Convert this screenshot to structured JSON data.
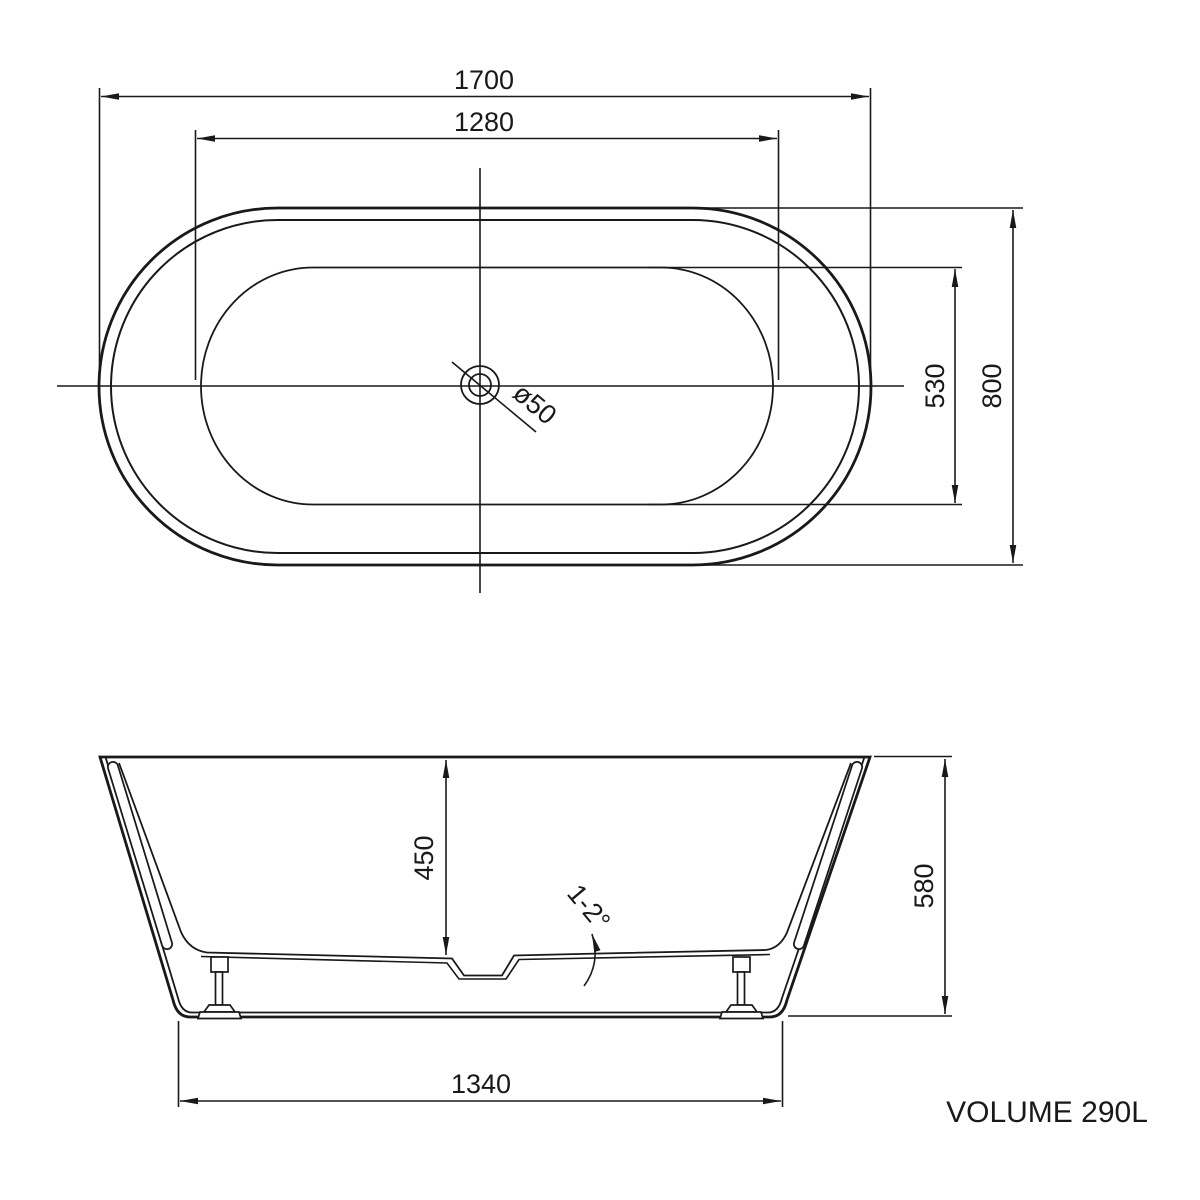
{
  "drawing": {
    "colors": {
      "line": "#191919",
      "fill": "#e9e9e9",
      "background": "#ffffff"
    },
    "top_view": {
      "dim_overall_length": "1700",
      "dim_basin_length": "1280",
      "dim_basin_width": "530",
      "dim_overall_width": "800",
      "drain_label": "ø50"
    },
    "side_view": {
      "dim_inner_depth": "450",
      "dim_overall_height": "580",
      "dim_base_length": "1340",
      "floor_slope_label": "1-2°"
    },
    "volume_label": "VOLUME 290L"
  }
}
